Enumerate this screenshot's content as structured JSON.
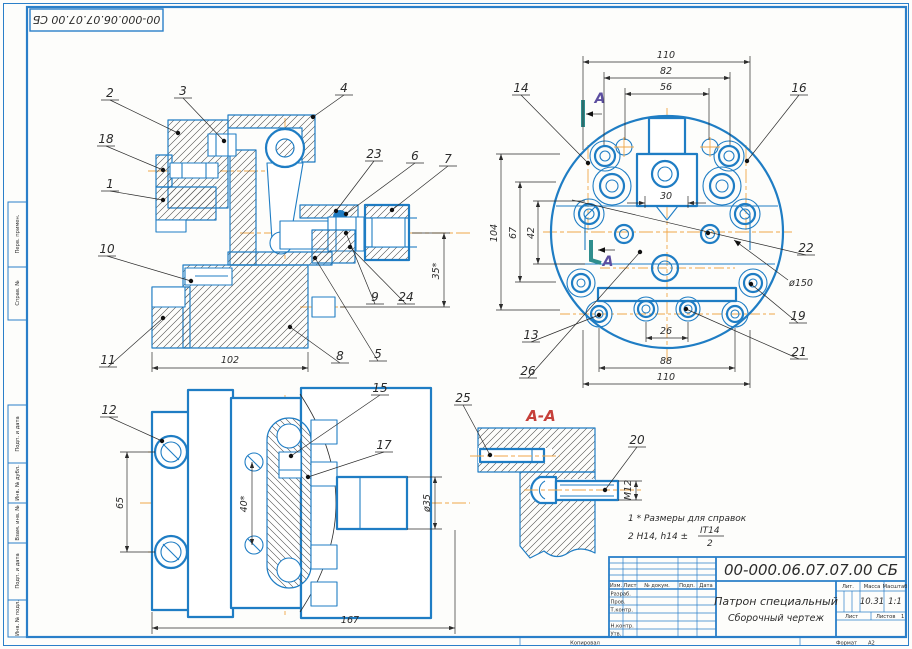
{
  "colors": {
    "frame_blue": "#2a7fc9",
    "line_blue": "#1f7dc4",
    "centerline_orange": "#f0a648",
    "section_red": "#c6403a",
    "section_label_purple": "#5c4ea0",
    "section_mark_teal": "#2f8e8e"
  },
  "stamp": {
    "doc_number_rotated": "00-000.06.07.07.00 СБ"
  },
  "margin_fields": {
    "perv": "Перв. примен.",
    "sprav": "Справ. №",
    "podp1": "Подп. и дата",
    "inv_dubl": "Инв. № дубл.",
    "vzam": "Взам. инв. №",
    "podp2": "Подп. и дата",
    "inv_podl": "Инв. № подл."
  },
  "main_view": {
    "callouts": {
      "n1": "1",
      "n2": "2",
      "n3": "3",
      "n4": "4",
      "n5": "5",
      "n6": "6",
      "n7": "7",
      "n8": "8",
      "n9": "9",
      "n10": "10",
      "n11": "11",
      "n18": "18",
      "n23": "23",
      "n24": "24"
    },
    "dims": {
      "w102": "102",
      "h35": "35*"
    }
  },
  "face_view": {
    "callouts": {
      "n13": "13",
      "n14": "14",
      "n16": "16",
      "n19": "19",
      "n21": "21",
      "n22": "22",
      "n26": "26"
    },
    "dims": {
      "top110": "110",
      "top82": "82",
      "top56": "56",
      "mid30": "30",
      "left104": "104",
      "left67": "67",
      "left42": "42",
      "bot26": "26",
      "bot88": "88",
      "bot110": "110",
      "dia150": "ø150"
    },
    "section_label": "А"
  },
  "bottom_view": {
    "callouts": {
      "n12": "12",
      "n15": "15",
      "n17": "17"
    },
    "dims": {
      "h65": "65",
      "a40": "40*",
      "d35": "ø35",
      "w167": "167"
    }
  },
  "section_aa": {
    "title": "А-А",
    "callouts": {
      "n20": "20",
      "n25": "25"
    },
    "dims": {
      "m12": "М12"
    }
  },
  "notes": {
    "line1": "1 * Размеры для справок",
    "line2_prefix": "2 Н14, h14 ±",
    "frac_num": "IT14",
    "frac_den": "2"
  },
  "title_block": {
    "doc_number": "00-000.06.07.07.00 СБ",
    "title": "Патрон специальный",
    "subtitle": "Сборочный чертеж",
    "col_izm": "Изм.",
    "col_list": "Лист",
    "col_doc": "№ докум.",
    "col_podp": "Подп.",
    "col_data": "Дата",
    "row_razrab": "Разраб.",
    "row_prov": "Пров.",
    "row_tkontr": "Т.контр.",
    "row_nkontr": "Н.контр.",
    "row_utv": "Утв.",
    "lit_label": "Лит.",
    "mass_label": "Масса",
    "scale_label": "Масштаб",
    "mass_value": "10.31",
    "scale_value": "1:1",
    "sheet_label": "Лист",
    "sheets_label": "Листов",
    "sheets_value": "1",
    "footer_copy": "Копировал",
    "footer_format_label": "Формат",
    "footer_format_value": "А2"
  }
}
